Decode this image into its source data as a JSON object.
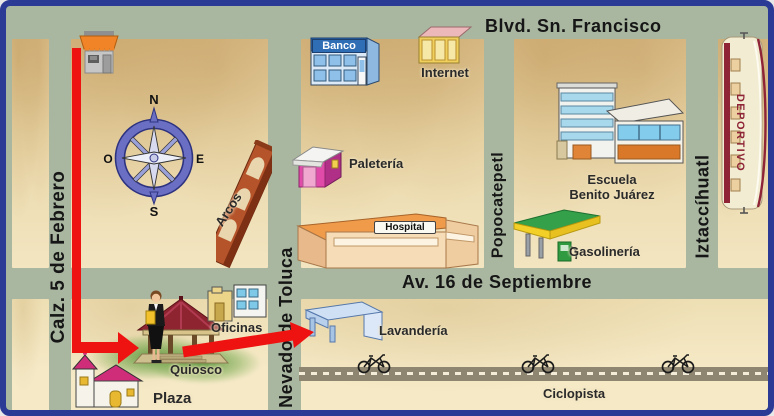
{
  "streets": {
    "blvd_sn_francisco": "Blvd. Sn. Francisco",
    "calz_5_de_febrero": "Calz. 5 de Febrero",
    "nevado_de_toluca": "Nevado de Toluca",
    "popocatepetl": "Popocatepetl",
    "iztaccihuatl": "Iztaccíhuatl",
    "av_16_de_septiembre": "Av. 16 de Septiembre"
  },
  "places": {
    "banco": "Banco",
    "internet": "Internet",
    "paleteria": "Paletería",
    "hospital": "Hospital",
    "escuela_line1": "Escuela",
    "escuela_line2": "Benito Juárez",
    "gasolineria": "Gasolinería",
    "deportivo": "DEPORTIVO",
    "arcos": "Arcos",
    "oficinas": "Oficinas",
    "lavanderia": "Lavandería",
    "quiosco": "Quiosco",
    "plaza": "Plaza",
    "ciclopista": "Ciclopista"
  },
  "compass": {
    "north": "N",
    "south": "S",
    "east": "E",
    "west": "O"
  },
  "colors": {
    "street": "#a9b7a0",
    "block_parchment": "#ecd9ad",
    "map_border": "#2b3a94",
    "route_red": "#ee1310",
    "street_label_text": "#161616",
    "deportivo_text": "#8e2436"
  }
}
